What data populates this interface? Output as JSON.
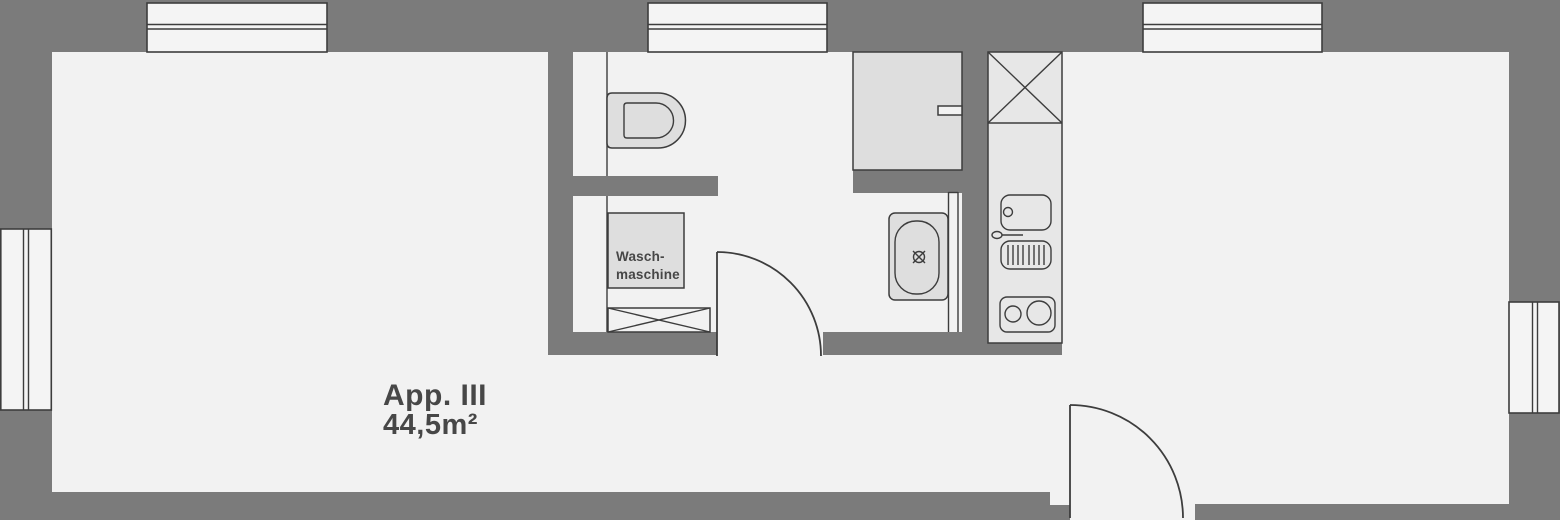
{
  "floorplan": {
    "apartment_label": {
      "title": "App. III",
      "area": "44,5m²"
    },
    "washing_machine_label": {
      "line1": "Wasch-",
      "line2": "maschine"
    },
    "fixtures": [
      "toilet",
      "washing-machine",
      "duct-shaft",
      "shower",
      "washbasin",
      "kitchen-sink",
      "drainboard",
      "cooktop",
      "kitchen-duct-shaft"
    ],
    "windows": {
      "top_count": 3,
      "left_count": 1,
      "right_count": 1
    },
    "doors": {
      "count": 2
    }
  },
  "colors": {
    "wall": "#7b7b7b",
    "floor": "#f2f2f2",
    "window_fill": "#f4f4f4",
    "fixture_fill": "#dedede",
    "counter_fill": "#e7e7e7",
    "outline": "#3d3d3d",
    "text": "#474747"
  }
}
